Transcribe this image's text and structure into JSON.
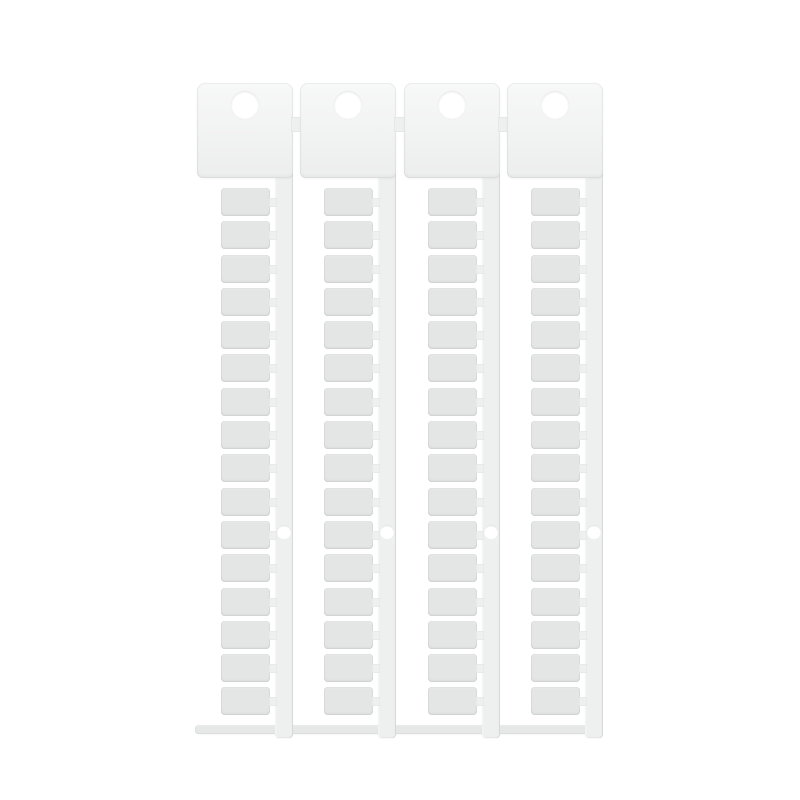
{
  "page": {
    "background": "#ffffff",
    "content": "product-photo-no-text"
  },
  "product": {
    "type": "blank-terminal-marker-card",
    "strip_count": 4,
    "tags_per_strip": 16,
    "total_tags": 64,
    "holes_per_strip": {
      "header_hanging_hole": 1,
      "spine_hole": 1
    },
    "colors": {
      "background": "#ffffff",
      "header_tab": "#f1f2f2",
      "tag": "#e4e6e6",
      "spine": "#eef0f0",
      "runner_bar": "#e6e8e8",
      "edge_shading": "#d8dada"
    }
  }
}
